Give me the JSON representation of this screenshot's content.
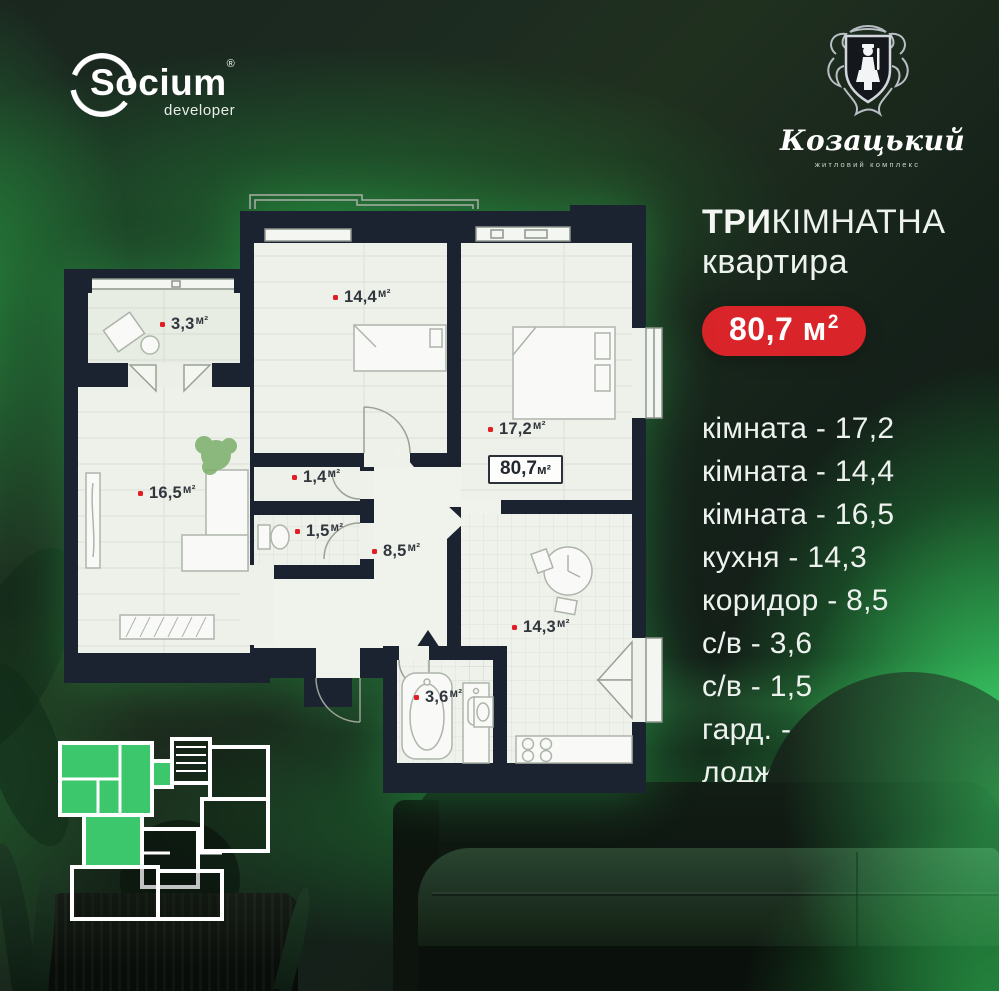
{
  "branding": {
    "developer": {
      "name": "Socium",
      "registered": "®",
      "tagline": "developer"
    },
    "complex": {
      "name": "Козацький",
      "tagline": "житловий комплекс"
    }
  },
  "offer": {
    "title_emphasis": "ТРИ",
    "title_rest": "КІМНАТНА",
    "subtitle": "квартира",
    "area_badge": {
      "value": "80,7 м",
      "sup": "2"
    }
  },
  "room_list": [
    "кімната - 17,2",
    "кімната - 14,4",
    "кімната - 16,5",
    "кухня - 14,3",
    "коридор - 8,5",
    "с/в - 3,6",
    "с/в - 1,5",
    "гард. - 1,4",
    "лоджія - 3,3"
  ],
  "floor_plan": {
    "unit": "м²",
    "total_area": "80,7",
    "labels": [
      {
        "room": "loggia",
        "value": "3,3"
      },
      {
        "room": "bedroom-1",
        "value": "14,4"
      },
      {
        "room": "bedroom-2",
        "value": "17,2"
      },
      {
        "room": "living-room",
        "value": "16,5"
      },
      {
        "room": "wardrobe",
        "value": "1,4"
      },
      {
        "room": "wc-small",
        "value": "1,5"
      },
      {
        "room": "corridor",
        "value": "8,5"
      },
      {
        "room": "kitchen",
        "value": "14,3"
      },
      {
        "room": "bathroom",
        "value": "3,6"
      }
    ]
  },
  "address": {
    "city": "м. Івано-Франківськ",
    "street": "вул. Довженка-Мазепи"
  },
  "colors": {
    "accent_red": "#d92429",
    "glow_green": "#2ecc5e",
    "plan_wall": "#1b2230",
    "plan_floor": "#eef1ea",
    "mini_plan_highlight": "#3cc76d"
  }
}
